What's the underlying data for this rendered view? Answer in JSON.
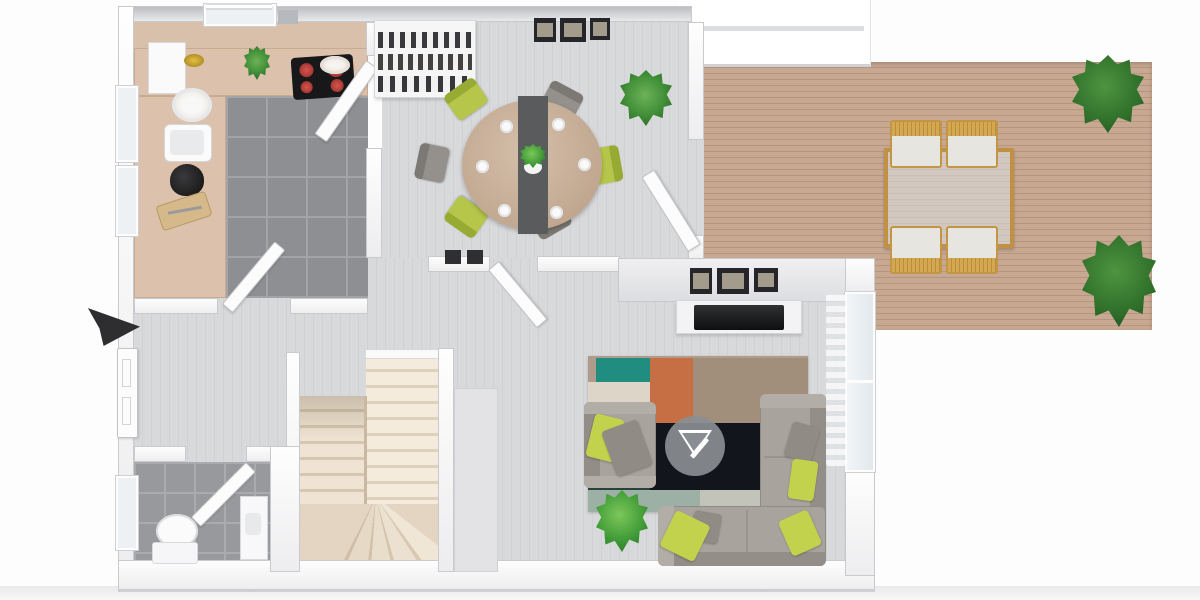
{
  "scene": {
    "description": "Top-down 3D rendered floor plan of a ground floor: kitchen, dining room, living room, entry hall, WC, U-shaped staircase and an outdoor wooden deck",
    "render_style": "photoreal 3D top view, no text labels",
    "background_color": "#ffffff"
  },
  "indicators": {
    "entrance_arrow": {
      "label": "Entrance",
      "shape": "3D black arrow",
      "direction": "points right at front door",
      "color": "#2e2e30"
    },
    "watermark": {
      "label": "Logo watermark",
      "shape": "gray circle badge with white inverted-triangle drafting logo",
      "location": "center of living-room rug"
    }
  },
  "rooms": {
    "kitchen": {
      "label": "Kitchen",
      "floor": "dark gray ceramic tile",
      "counter_color": "#dcc2ac",
      "items": [
        "L-shaped counter",
        "cooktop with 4 red burners",
        "sink",
        "tall white cabinet",
        "black coffee maker",
        "cutting board with knife",
        "potted herb",
        "gold fruit bowl",
        "plate of pastries",
        "white serving plate",
        "door to dining room",
        "door to hall",
        "window"
      ]
    },
    "dining": {
      "label": "Dining room",
      "floor": "light gray plank wood",
      "items": [
        "round dining table with dark runner and 6 place settings",
        "3 chartreuse chairs",
        "3 gray chairs",
        "white bookshelf sideboard with books",
        "three-panel wall art",
        "potted plant",
        "glass door to deck"
      ]
    },
    "living": {
      "label": "Living room",
      "floor": "light gray plank wood",
      "items": [
        "gray corner sofa",
        "gray armchair",
        "5 chartreuse and gray throw pillows",
        "patchwork rug (teal, orange, tan, cream, dark navy)",
        "TV on white console",
        "three framed pictures above TV",
        "potted plant",
        "glass sliding door with sheer curtain"
      ]
    },
    "hall": {
      "label": "Entry hall",
      "floor": "light gray plank wood",
      "items": [
        "white front door",
        "interior door to living room",
        "two dark wall panels"
      ]
    },
    "stairs": {
      "label": "U-shaped staircase",
      "tread_color": "#f2e8d9",
      "detail": "two flights with winder treads at the turn"
    },
    "wc": {
      "label": "WC",
      "floor": "gray tile",
      "items": [
        "toilet",
        "washbasin cabinet",
        "inward-swinging door",
        "window"
      ]
    },
    "deck": {
      "label": "Wooden deck",
      "floor": "brown wood planks",
      "items": [
        "outdoor glass-top table with tan wood frame",
        "4 wooden chairs with white cushions",
        "2 potted plants"
      ]
    }
  },
  "palette": {
    "wall_white": "#f7f7f9",
    "wall_edge": "#c9cacd",
    "wood_floor_light": "#d6d7d9",
    "kitchen_tile": "#8d8f92",
    "kitchen_counter": "#dcc2ac",
    "stairs_cream": "#f2e8d9",
    "deck_wood": "#c2a28b",
    "accent_chartreuse": "#c3d24c",
    "accent_teal": "#218d80",
    "accent_orange": "#c76f44",
    "rug_dark": "#14181e",
    "sofa_gray": "#a8a49d",
    "plant_green": "#449b3b",
    "arrow_black": "#2e2e30",
    "outdoor_frame_tan": "#c49545",
    "cooktop_black": "#18181a",
    "burner_red": "#c2413b"
  }
}
